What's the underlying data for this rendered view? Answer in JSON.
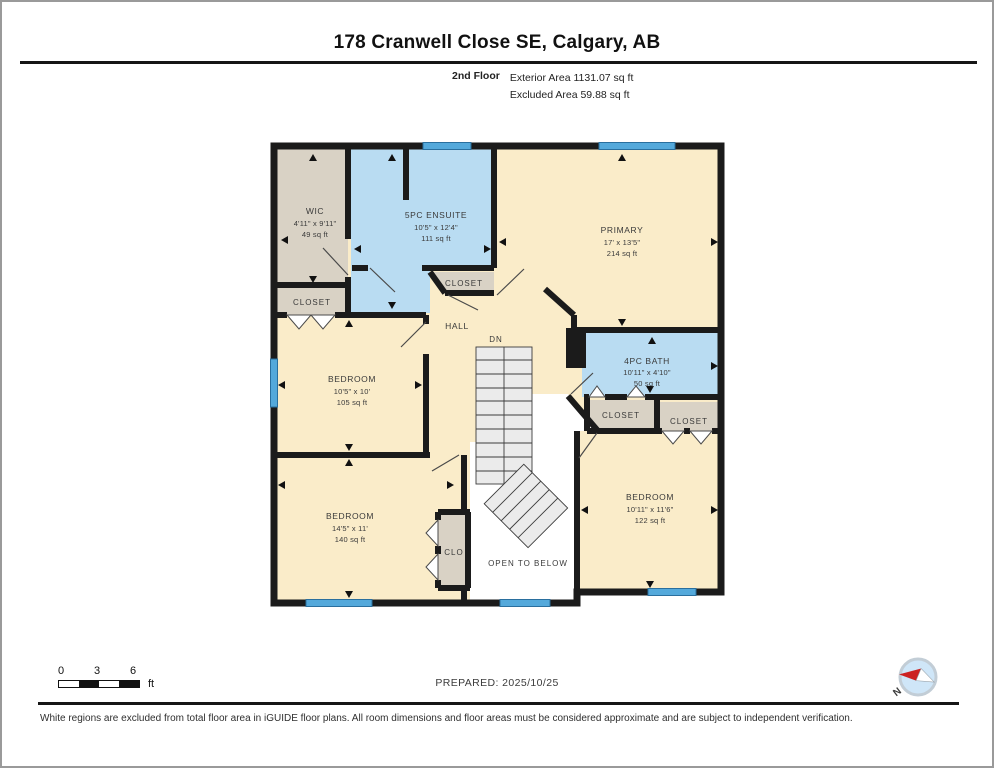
{
  "header": {
    "title": "178 Cranwell Close SE, Calgary, AB",
    "floor_label": "2nd Floor",
    "exterior_area": "Exterior Area 1131.07 sq ft",
    "excluded_area": "Excluded Area 59.88 sq ft"
  },
  "rooms": {
    "wic": {
      "name": "WIC",
      "dims": "4'11\" x 9'11\"",
      "area": "49 sq ft"
    },
    "ensuite": {
      "name": "5PC ENSUITE",
      "dims": "10'5\" x 12'4\"",
      "area": "111 sq ft"
    },
    "primary": {
      "name": "PRIMARY",
      "dims": "17' x 13'5\"",
      "area": "214 sq ft"
    },
    "bath": {
      "name": "4PC BATH",
      "dims": "10'11\" x 4'10\"",
      "area": "50 sq ft"
    },
    "bedroom_mid": {
      "name": "BEDROOM",
      "dims": "10'5\" x 10'",
      "area": "105 sq ft"
    },
    "bedroom_bl": {
      "name": "BEDROOM",
      "dims": "14'5\" x 11'",
      "area": "140 sq ft"
    },
    "bedroom_br": {
      "name": "BEDROOM",
      "dims": "10'11\" x 11'6\"",
      "area": "122 sq ft"
    }
  },
  "labels": {
    "hall": "HALL",
    "dn": "DN",
    "closet": "CLOSET",
    "clo": "CLO",
    "open_below": "OPEN TO BELOW"
  },
  "footer": {
    "prepared": "PREPARED: 2025/10/25",
    "scale": {
      "t0": "0",
      "t3": "3",
      "t6": "6",
      "unit": "ft"
    },
    "compass_n": "N",
    "disclaimer": "White regions are excluded from total floor area in iGUIDE floor plans. All room dimensions and floor areas must be considered approximate and are subject to independent verification."
  },
  "colors": {
    "wall": "#1b1b1b",
    "room_cream": "#faecc9",
    "closet_tan": "#d9d2c5",
    "wet_blue": "#b9dcf2",
    "window_blue": "#54a9db",
    "window_border": "#2a6f9e",
    "stair_gray": "#ebebeb",
    "open_white": "#ffffff",
    "compass_blue": "#cfe6f8",
    "compass_red": "#cc2222",
    "label_gray": "#3a3a3a"
  }
}
